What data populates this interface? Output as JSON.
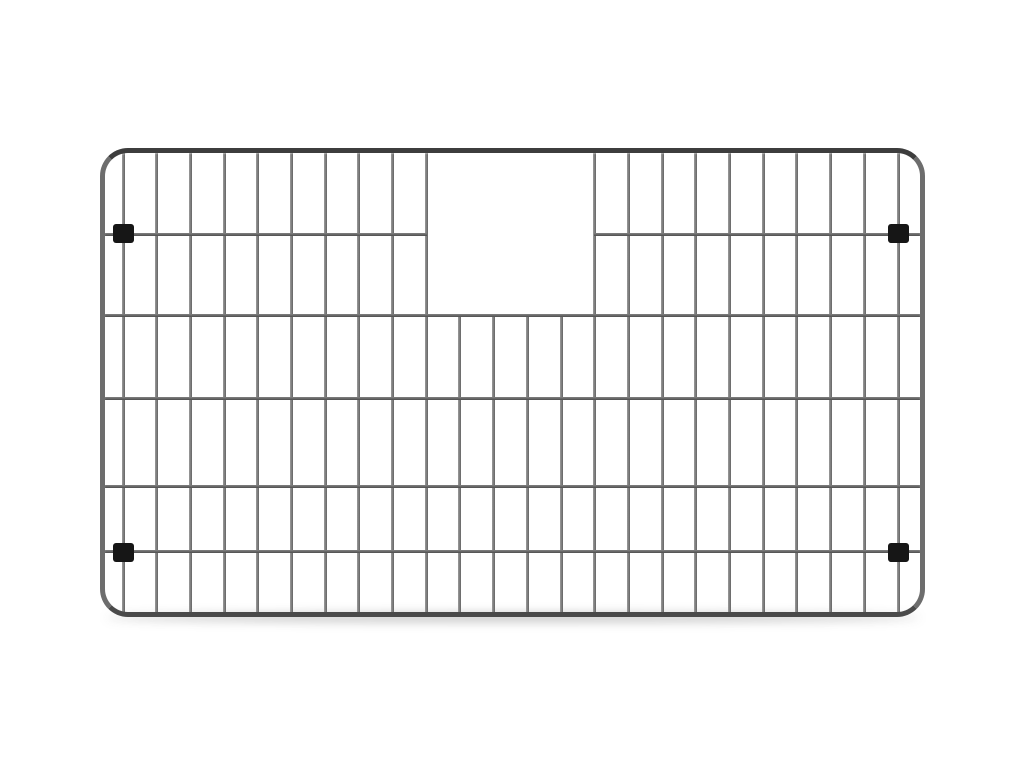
{
  "meta": {
    "title": "Stainless steel sink bottom grid product photo",
    "background_color": "#ffffff",
    "subject": "wire sink grid with rectangular top-center cutout and four black corner feet"
  },
  "grid": {
    "frame": {
      "x": 100,
      "y": 148,
      "width": 825,
      "height": 469,
      "corner_radius": 28,
      "tube_thickness": 5,
      "color_top": "#3d3d3d",
      "color_sides": "#6d6d6d",
      "color_bottom": "#4a4a4a",
      "inner_highlight": "rgba(255,255,255,0.35)"
    },
    "vertical_wires": {
      "count": 24,
      "first_x": 123,
      "last_x": 898,
      "thickness": 3,
      "top_y": 151,
      "bottom_y": 614,
      "color_light": "#9c9c9c",
      "color_dark": "#646464",
      "short_wire_indexes": [
        10,
        11,
        12,
        13
      ],
      "short_top_y": 315
    },
    "horizontal_wires": {
      "rows_y": [
        234,
        315,
        398,
        486,
        551
      ],
      "left_x": 103,
      "right_x": 922,
      "thickness": 3,
      "color_light": "#828282",
      "color_dark": "#4f4f4f",
      "interrupted_row": 0,
      "gap_left_x": 427,
      "gap_right_x": 594
    },
    "cutout": {
      "left_x": 427,
      "top_y": 152,
      "right_x": 594,
      "bottom_y": 315
    },
    "feet": {
      "width": 21,
      "height": 19,
      "corner_radius": 3,
      "color": "#161616",
      "centers": [
        {
          "x": 123,
          "y": 233
        },
        {
          "x": 898,
          "y": 233
        },
        {
          "x": 123,
          "y": 552
        },
        {
          "x": 898,
          "y": 552
        }
      ]
    },
    "ground_shadow": {
      "x": 106,
      "y": 613,
      "width": 814,
      "height": 9,
      "color": "rgba(45,45,45,0.28)",
      "blur": 5
    }
  }
}
